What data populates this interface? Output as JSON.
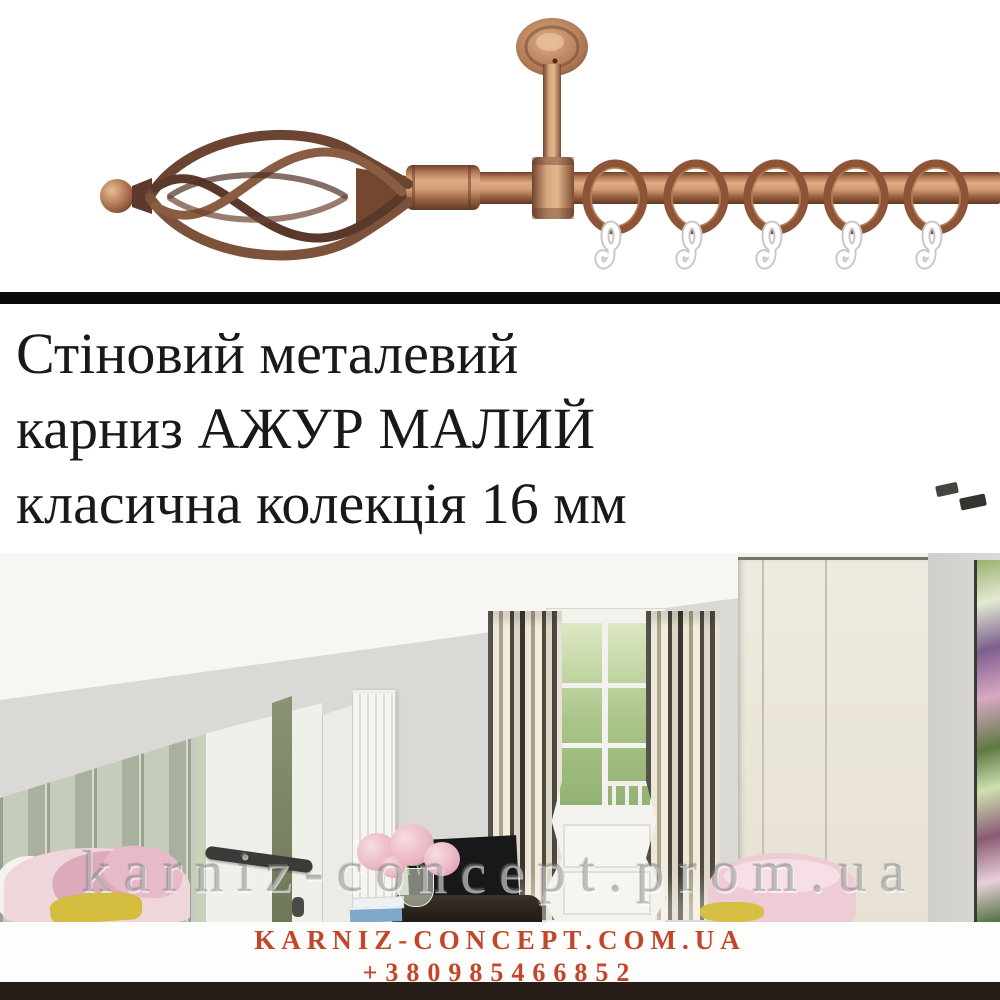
{
  "title": {
    "line1": "Стіновий металевий",
    "line2": "карниз АЖУР МАЛИЙ",
    "line3": "класична колекція 16 мм"
  },
  "specs": {
    "line1": "однорядний",
    "line2": "колір:",
    "line3": "мідь"
  },
  "watermark": {
    "text": "karniz-concept.prom.ua"
  },
  "footer": {
    "website": "KARNIZ-CONCEPT.COM.UA",
    "phone": "+380985466852"
  },
  "product_photo": {
    "subject": "copper single-row curtain rod with twisted cage finial, ceiling bracket, five rings with white hooks",
    "rings_count": 5
  },
  "palette": {
    "copper": "#b5774f",
    "copper_dark": "#6e412e",
    "divider_black": "#0a0a0a",
    "footer_red": "#c3452a",
    "background": "#ffffff",
    "bottom_bar": "#261d18"
  }
}
